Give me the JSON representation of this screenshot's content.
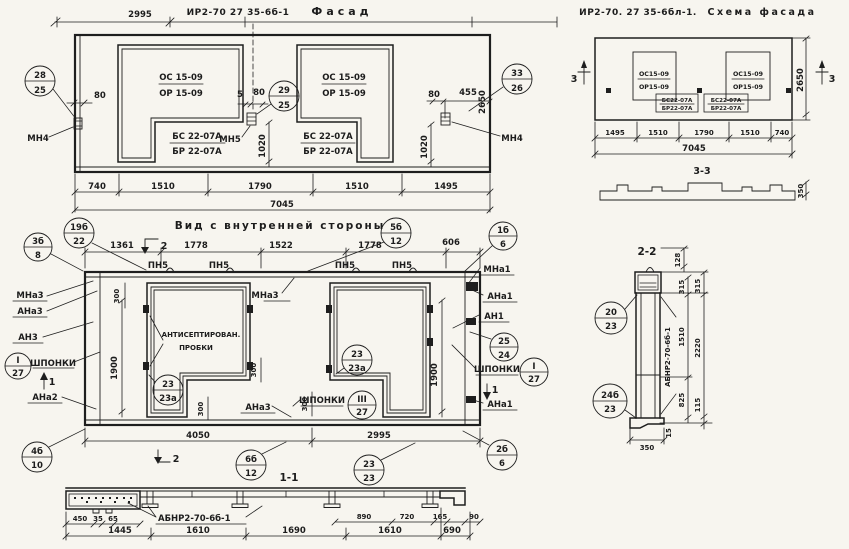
{
  "colors": {
    "ink": "#1e1e1e",
    "paper": "#f7f5ef"
  },
  "facade": {
    "code": "ИР2-70 27 35-6б-1",
    "title": "Фасад",
    "dim_top": "2995",
    "win_top": "ОС 15-09",
    "win_bot": "ОР 15-09",
    "block_top": "БС 22-07А",
    "block_bot": "БР 22-07А",
    "mn4": "МН4",
    "mn5": "МН5",
    "callouts": {
      "left": {
        "top": "28",
        "bot": "25"
      },
      "mid": {
        "top": "29",
        "bot": "25"
      },
      "right": {
        "top": "33",
        "bot": "26"
      }
    },
    "d80": "80",
    "d5": "5",
    "d455": "455",
    "d1020": "1020",
    "d2650": "2650",
    "dims_bottom": [
      "740",
      "1510",
      "1790",
      "1510",
      "1495"
    ],
    "dim_total": "7045"
  },
  "scheme": {
    "code": "ИР2-70. 27 35-6бл-1.",
    "title": "Схема фасада",
    "win_top": "ОС15-09",
    "win_bot": "ОР15-09",
    "block1_top": "БС22-07А",
    "block1_bot": "БР22-07А",
    "block2_top": "БС22-07А",
    "block2_bot": "БР22-07А",
    "mark": "3",
    "d2650": "2650",
    "dims_bottom": [
      "1495",
      "1510",
      "1790",
      "1510",
      "740"
    ],
    "dim_total": "7045",
    "section_title": "3-3",
    "d350": "350"
  },
  "inner": {
    "title": "Вид с внутренней стороны",
    "dims_top": [
      "1361",
      "1778",
      "1522",
      "1778",
      "606"
    ],
    "pn5": "ПН5",
    "mark1": "1",
    "mark2": "2",
    "d300": "300",
    "d1900": "1900",
    "d4050": "4050",
    "d2995": "2995",
    "labels": {
      "mna3": "МНа3",
      "ana3": "АНа3",
      "an3": "АН3",
      "ana2": "АНа2",
      "mna1": "МНа1",
      "ana1": "АНа1",
      "an1": "АН1",
      "shponki": "ШПОНКИ",
      "plug_line1": "АНТИСЕПТИРОВАН.",
      "plug_line2": "ПРОБКИ"
    },
    "callouts": {
      "c3b8": {
        "top": "3б",
        "bot": "8"
      },
      "c19b22": {
        "top": "19б",
        "bot": "22"
      },
      "c5b12": {
        "top": "5б",
        "bot": "12"
      },
      "c1b6": {
        "top": "1б",
        "bot": "6"
      },
      "c2524": {
        "top": "25",
        "bot": "24"
      },
      "cI27": {
        "top": "I",
        "bot": "27"
      },
      "cIII27": {
        "top": "III",
        "bot": "27"
      },
      "c23a": {
        "top": "23",
        "bot": "23а"
      },
      "c4b10": {
        "top": "4б",
        "bot": "10"
      },
      "c2b6": {
        "top": "2б",
        "bot": "6"
      },
      "c6b12": {
        "top": "6б",
        "bot": "12"
      },
      "c2323": {
        "top": "23",
        "bot": "23"
      }
    }
  },
  "sec11": {
    "title": "1-1",
    "beam_label": "АБНР2-70-6б-1",
    "dims_small": [
      "450",
      "35",
      "65",
      "890",
      "720",
      "165",
      "90"
    ],
    "dims_big": [
      "1445",
      "1610",
      "1690",
      "1610",
      "690"
    ]
  },
  "sec22": {
    "title": "2-2",
    "beam_label": "АБНР2-70-6б-1",
    "d128": "128",
    "d315": "315",
    "d1510": "1510",
    "d2220": "2220",
    "d825": "825",
    "d115": "115",
    "d15": "15",
    "d350": "350",
    "callouts": {
      "c2023": {
        "top": "20",
        "bot": "23"
      },
      "c24b23": {
        "top": "24б",
        "bot": "23"
      }
    }
  }
}
